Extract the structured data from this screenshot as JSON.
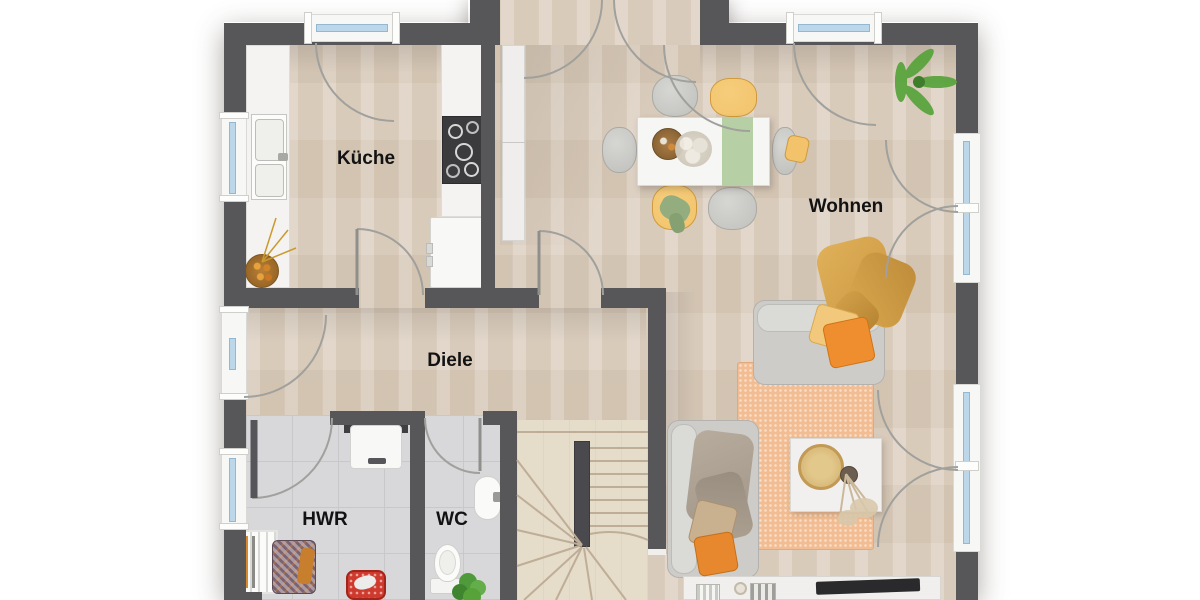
{
  "rooms": {
    "kueche": {
      "label": "Küche"
    },
    "wohnen": {
      "label": "Wohnen"
    },
    "diele": {
      "label": "Diele"
    },
    "hwr": {
      "label": "HWR"
    },
    "wc": {
      "label": "WC"
    }
  },
  "colors": {
    "wall": "#57575a",
    "wood": "#dccfbf",
    "stairwood": "#e6dcca",
    "tile": "#d8d8da",
    "tileline": "#c8c8ca",
    "glass": "#bcd7ea",
    "green": "#b7cfa4",
    "yellow": "#f2c36b",
    "orange": "#ee8e2f",
    "mustard": "#d9a84e",
    "graysofa": "#cdccc8",
    "rug": "#f2bd92",
    "plant": "#5daf3c",
    "arc": "#a0a09c"
  },
  "furniture_icons": [
    "kitchen-counter",
    "kitchen-sink",
    "stove",
    "refrigerator",
    "hall-cabinet",
    "fruit-bowl",
    "dining-table",
    "table-runner",
    "dining-chair",
    "centerpiece",
    "potted-palm",
    "sofa",
    "lounge-sofa",
    "cushion",
    "throw-blanket",
    "rug",
    "coffee-table",
    "decor-tray",
    "pampas-vase",
    "tv-sideboard",
    "tv",
    "water-heater",
    "drying-rack",
    "laundry-basket",
    "storage-basket",
    "toilet",
    "wash-basin",
    "wc-plant",
    "staircase",
    "window",
    "door-swing"
  ]
}
